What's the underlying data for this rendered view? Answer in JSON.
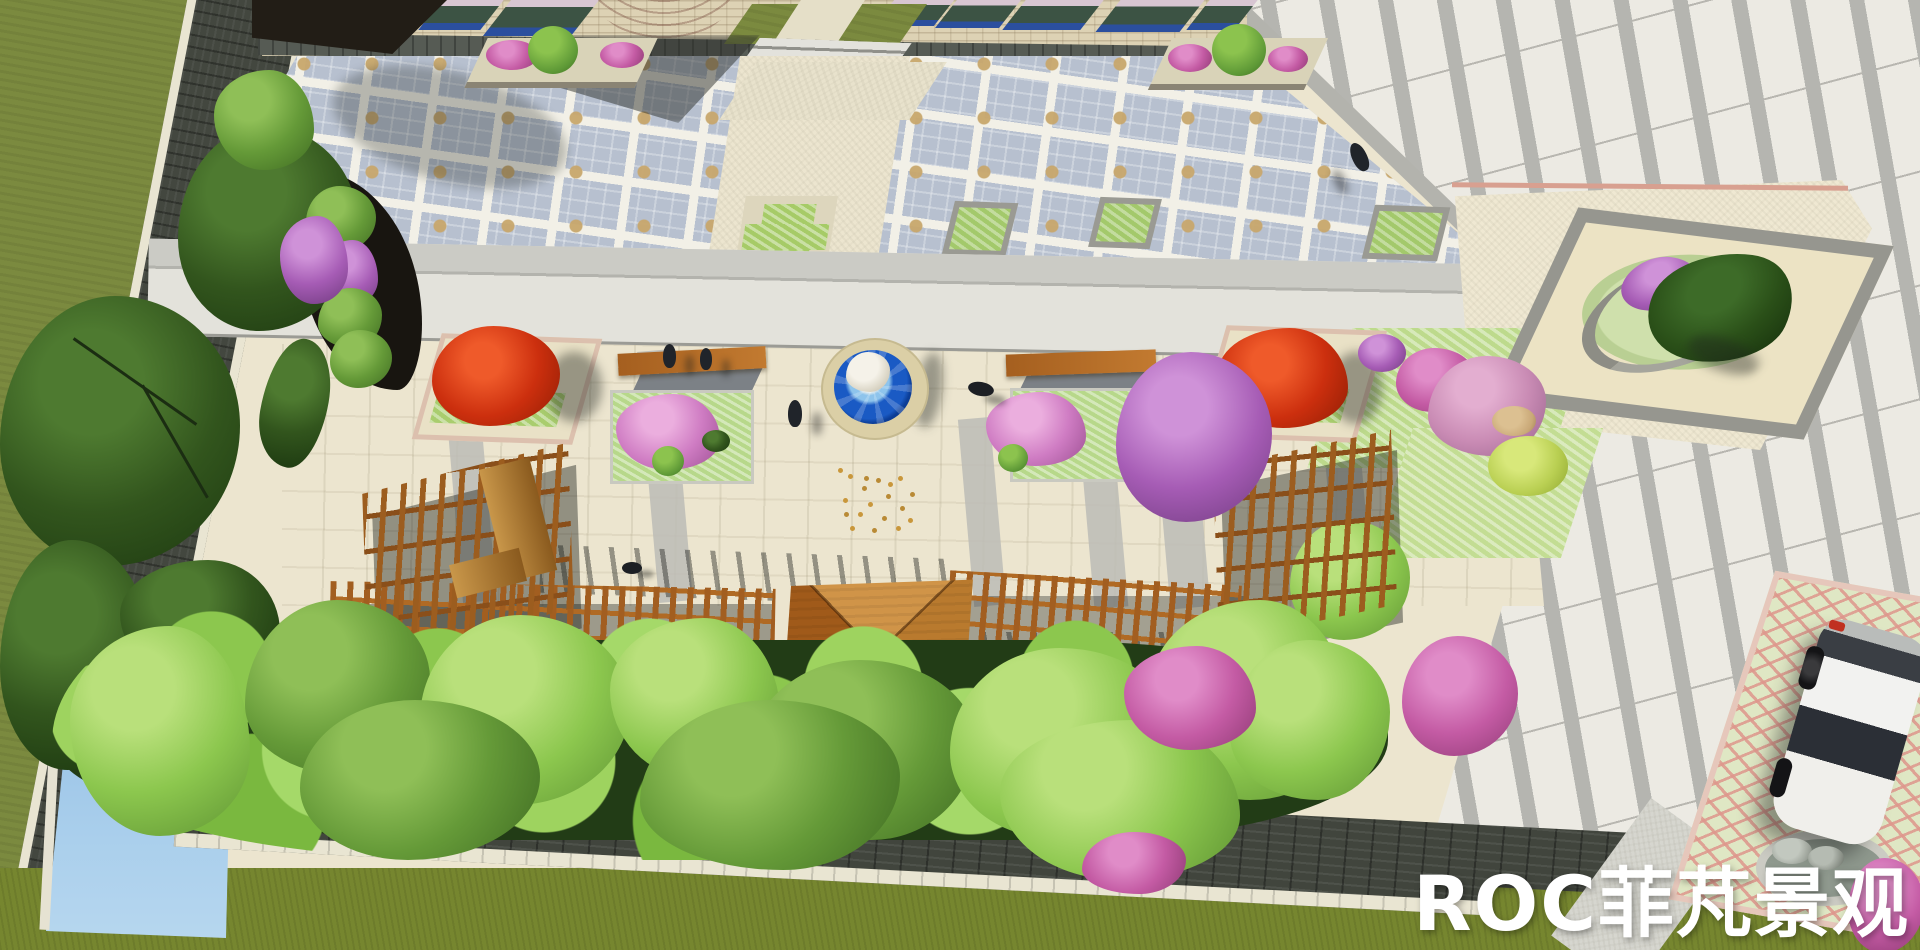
{
  "watermark": {
    "text": "ROC菲芃景观",
    "color": "#ffffff"
  },
  "palette": {
    "lawn": "#7b8a3f",
    "grass": "#76862f",
    "path": "#41453d",
    "curb": "#e9e5d2",
    "checker": "#b7c0cf",
    "tan": "#c8a76c",
    "cream": "#ece5cf",
    "walk": "#e3e2db",
    "stripe": "#b5b5b0",
    "stripebg": "#eceae3",
    "wood": "#9c5d1f",
    "wood2": "#8a4f1a",
    "red": "#cc2f0e",
    "pink": "#cf7cc3",
    "magenta": "#c45ba4",
    "purple": "#a65cb5",
    "leaf1": "#9ed35f",
    "leaf2": "#659a38",
    "leaf3": "#2c4a20",
    "pond1": "#aacfec",
    "pond2": "#274a77",
    "fount": "#1a5ac4",
    "rim": "#dbcfa6",
    "brick": "#ddd2b4",
    "win": "#3c5344",
    "winblue": "#2b4f9e",
    "tower": "#cf9a88",
    "car": "#f2f2f0",
    "wm": "#ffffff"
  },
  "objects": {
    "people": 4,
    "dogs": 2,
    "cars": 1,
    "fountains": 1,
    "pergolas": 3,
    "pavilions": 1
  }
}
